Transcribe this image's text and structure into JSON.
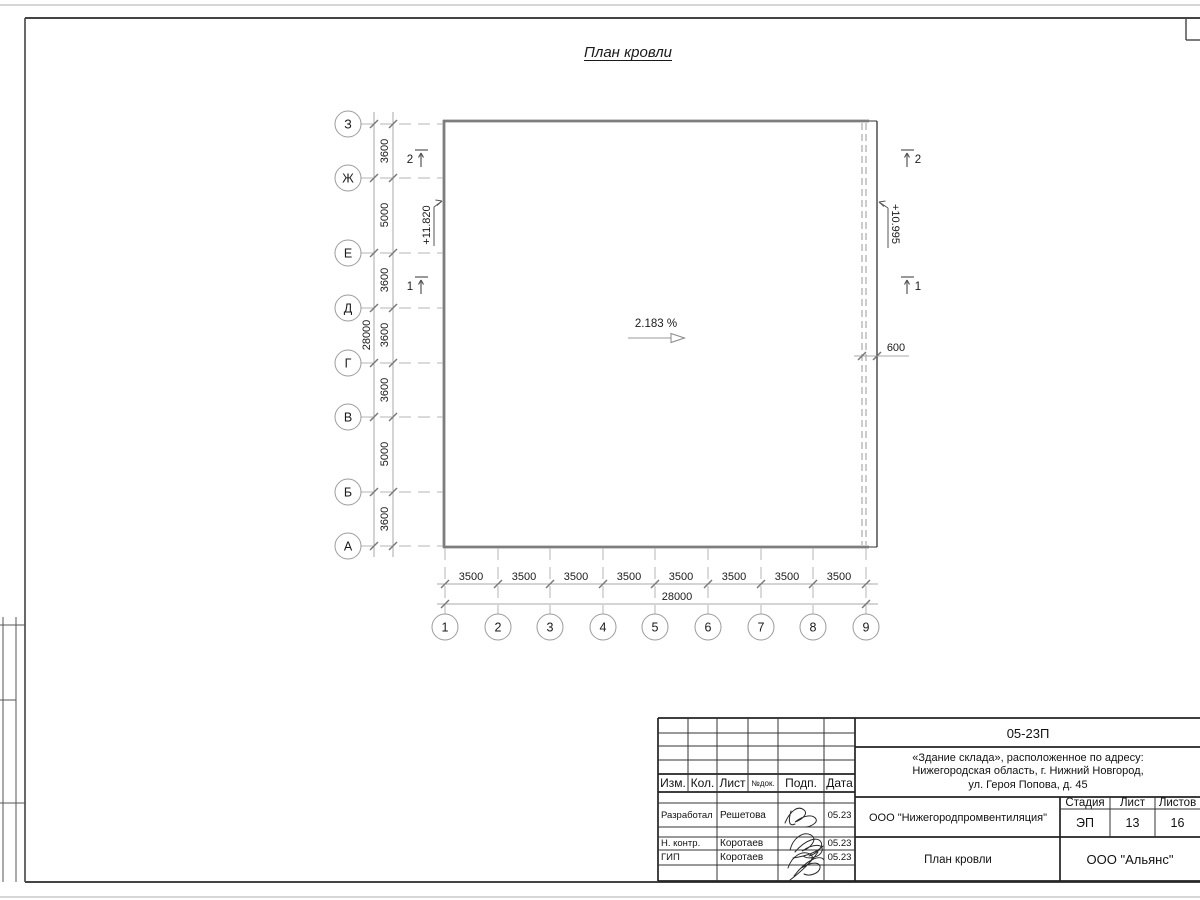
{
  "drawing": {
    "title": "План кровли",
    "slope_label": "2.183 %",
    "elev_left": "+11.820",
    "elev_right": "+10.995",
    "offset_dim": "600",
    "v_axes": [
      "З",
      "Ж",
      "Е",
      "Д",
      "Г",
      "В",
      "Б",
      "А"
    ],
    "v_dims": [
      "3600",
      "5000",
      "3600",
      "3600",
      "3600",
      "5000",
      "3600"
    ],
    "v_total": "28000",
    "h_axes": [
      "1",
      "2",
      "3",
      "4",
      "5",
      "6",
      "7",
      "8",
      "9"
    ],
    "h_dims": [
      "3500",
      "3500",
      "3500",
      "3500",
      "3500",
      "3500",
      "3500",
      "3500"
    ],
    "h_total": "28000",
    "sections": {
      "left_top": "2",
      "left_bottom": "1",
      "right_top": "2",
      "right_bottom": "1"
    }
  },
  "titleblock": {
    "code": "05-23П",
    "project_line1": "«Здание склада», расположенное по адресу:",
    "project_line2": "Нижегородская область, г. Нижний Новгород,",
    "project_line3": "ул. Героя Попова, д. 45",
    "rev_headers": {
      "izm": "Изм.",
      "kol": "Кол.",
      "list": "Лист",
      "ndok": "№док.",
      "podp": "Подп.",
      "data": "Дата"
    },
    "staff": [
      {
        "role": "Разработал",
        "name": "Решетова",
        "date": "05.23"
      },
      {
        "role": "Н. контр.",
        "name": "Коротаев",
        "date": "05.23"
      },
      {
        "role": "ГИП",
        "name": "Коротаев",
        "date": "05.23"
      }
    ],
    "company": "ООО \"Нижегородпромвентиляция\"",
    "stage_label": "Стадия",
    "sheet_label": "Лист",
    "sheets_label": "Листов",
    "stage": "ЭП",
    "sheet": "13",
    "sheets": "16",
    "sheet_title": "План кровли",
    "org": "ООО \"Альянс\""
  }
}
